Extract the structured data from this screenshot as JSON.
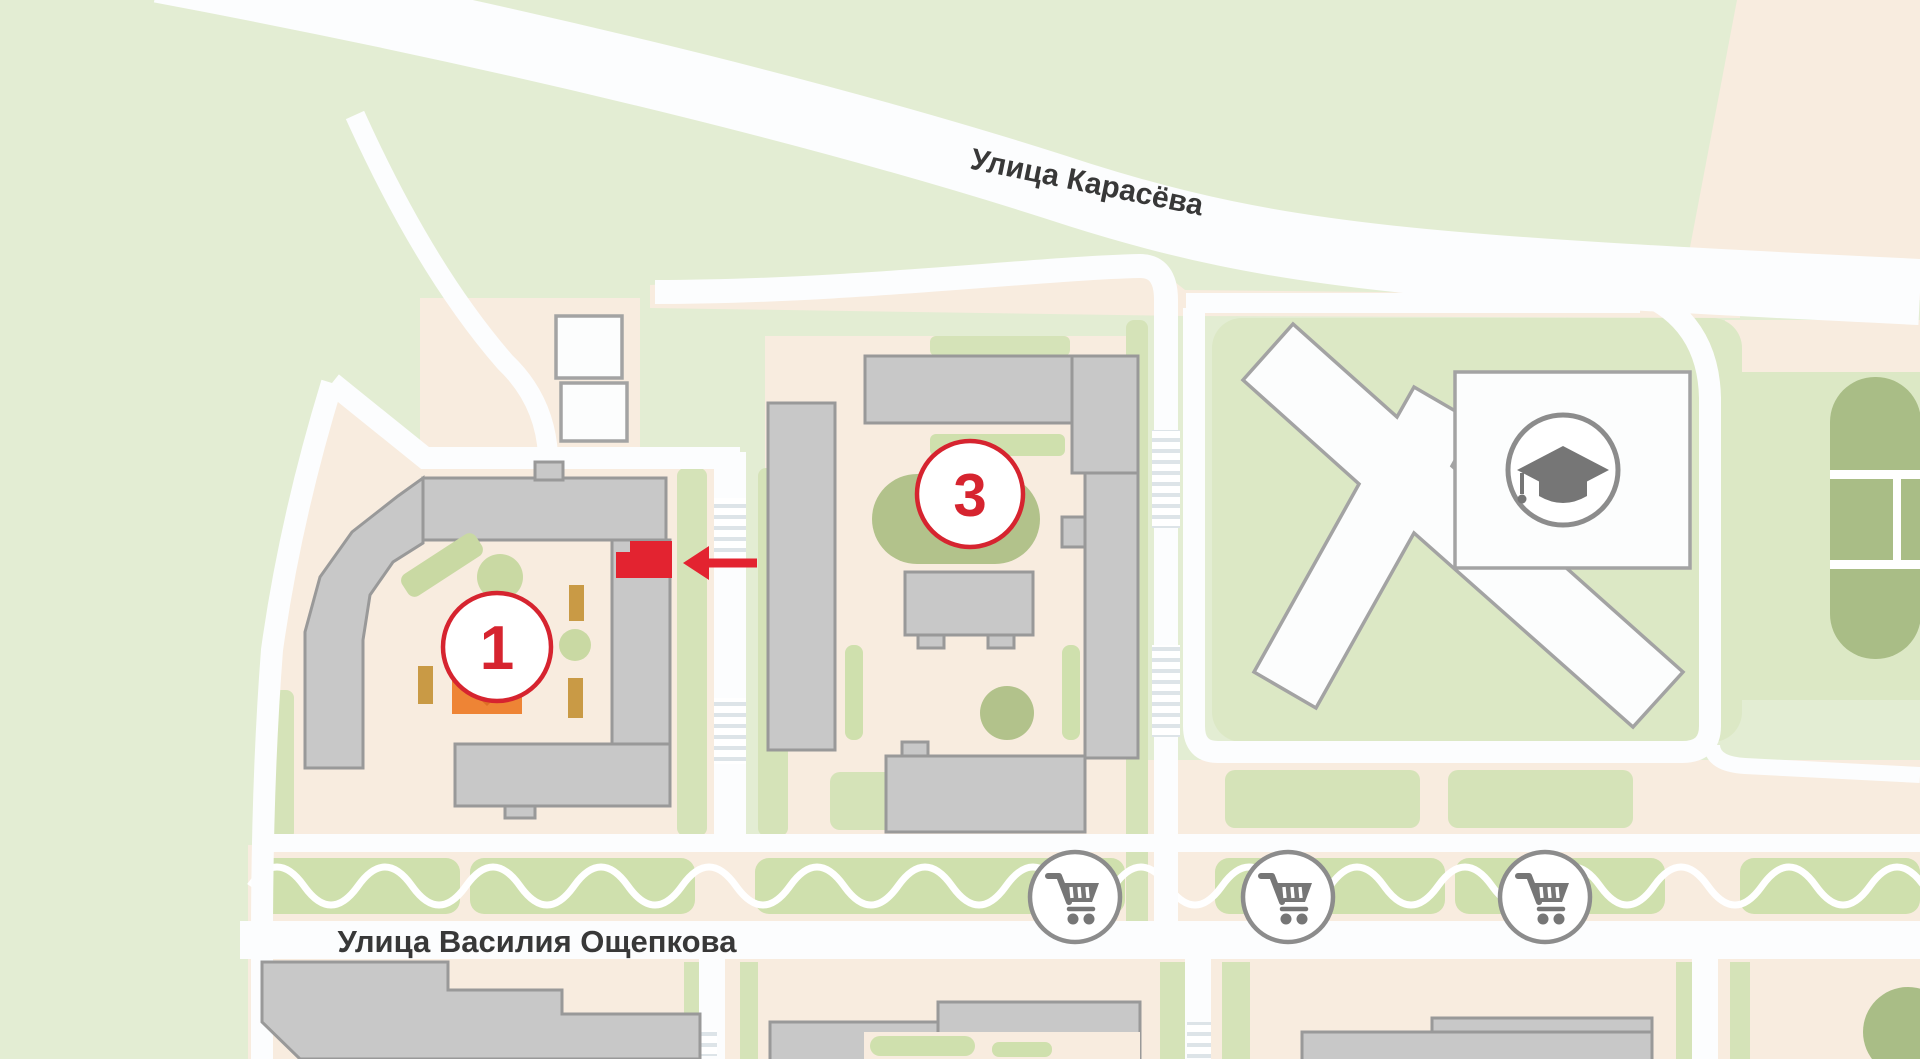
{
  "map": {
    "streets": {
      "karasyova": "Улица Карасёва",
      "oshchepkova": "Улица Василия Ощепкова"
    },
    "markers": {
      "building1": "1",
      "building3": "3"
    },
    "highlight": {
      "description": "highlighted-apartment-section-with-arrow",
      "building": "1"
    },
    "poi": {
      "school_icon": "graduation-cap",
      "shop_icon": "shopping-cart",
      "shop_count": "3"
    },
    "colors": {
      "accent_red": "#e32330",
      "marker_red": "#d6242f",
      "building_gray": "#c8c8c8",
      "greenery": "#e3edd3",
      "field_green": "#a9bd86",
      "playground_orange": "#ee8435",
      "bench_tan": "#c99a45",
      "road_white": "#fcfdfe",
      "label_dark": "#383838",
      "icon_gray": "#767676"
    }
  }
}
